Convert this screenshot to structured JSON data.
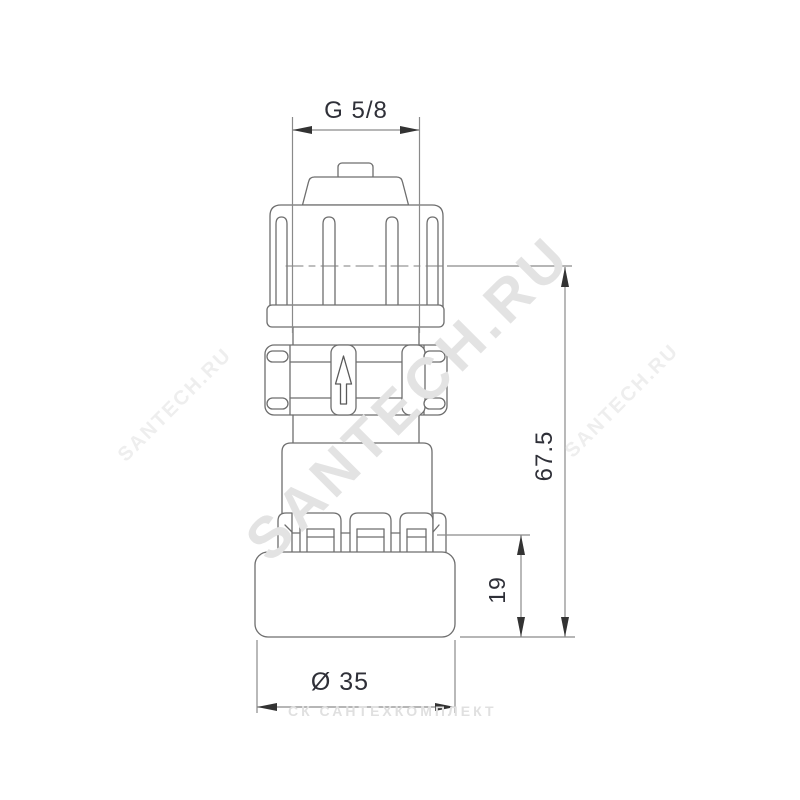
{
  "drawing": {
    "type": "technical-drawing",
    "subject": "automatic air vent valve fitting, front elevation with dimensions",
    "dimensions": {
      "thread_label": "G 5/8",
      "overall_height_label": "67.5",
      "base_height_label": "19",
      "base_diameter_label": "Ø 35"
    },
    "symbols": {
      "flow_arrow": "up-arrow-flow-direction"
    },
    "colors": {
      "background": "#ffffff",
      "outline": "#6e6e6e",
      "dimension_line": "#8a8a8a",
      "dimension_text": "#2f3038",
      "arrowhead": "#333333",
      "watermark_large": "#e3e3e3",
      "watermark_small": "#eeeeee",
      "watermark_bottom": "#e0e0e0"
    }
  },
  "watermarks": {
    "diagonal_large": "SANTECH.RU",
    "diagonal_small_left": "SANTECH.RU",
    "diagonal_small_right": "SANTECH.RU",
    "bottom": "СК САНТЕХКОМПЛЕКТ"
  }
}
